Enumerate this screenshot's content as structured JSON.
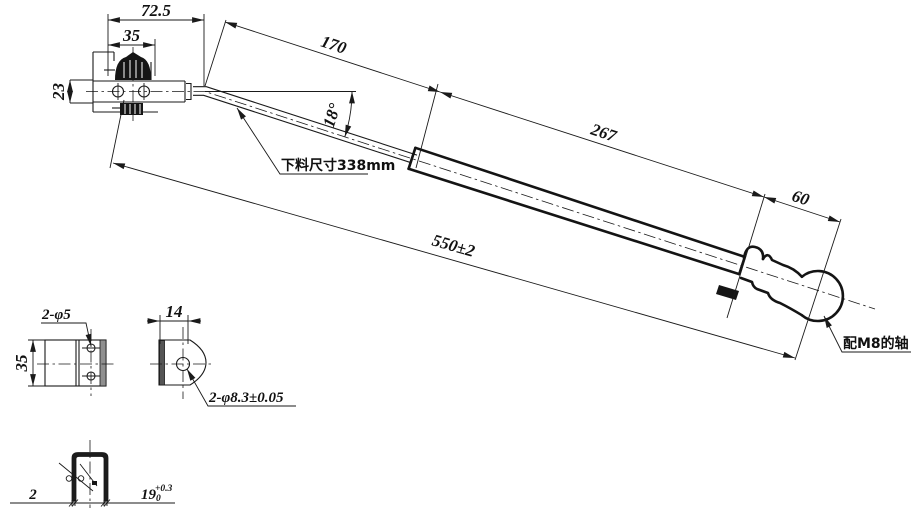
{
  "drawing": {
    "colors": {
      "background": "#ffffff",
      "line": "#1a1a1a"
    },
    "main_view": {
      "dim_72_5": "72.5",
      "dim_35": "35",
      "dim_23": "23",
      "dim_170": "170",
      "angle_18": "18°",
      "dim_267": "267",
      "dim_60": "60",
      "dim_550": "550±2",
      "blank_size_note": "下料尺寸338mm",
      "shaft_note": "配M8的轴"
    },
    "side_view": {
      "hole_callout": "2-φ5",
      "dim_35": "35"
    },
    "end_view": {
      "dim_14": "14",
      "hole_callout": "2-φ8.3±0.05"
    },
    "section_view": {
      "dim_2": "2",
      "dim_19": "19",
      "dim_19_tol_upper": "+0.3",
      "dim_19_tol_lower": "0"
    }
  }
}
